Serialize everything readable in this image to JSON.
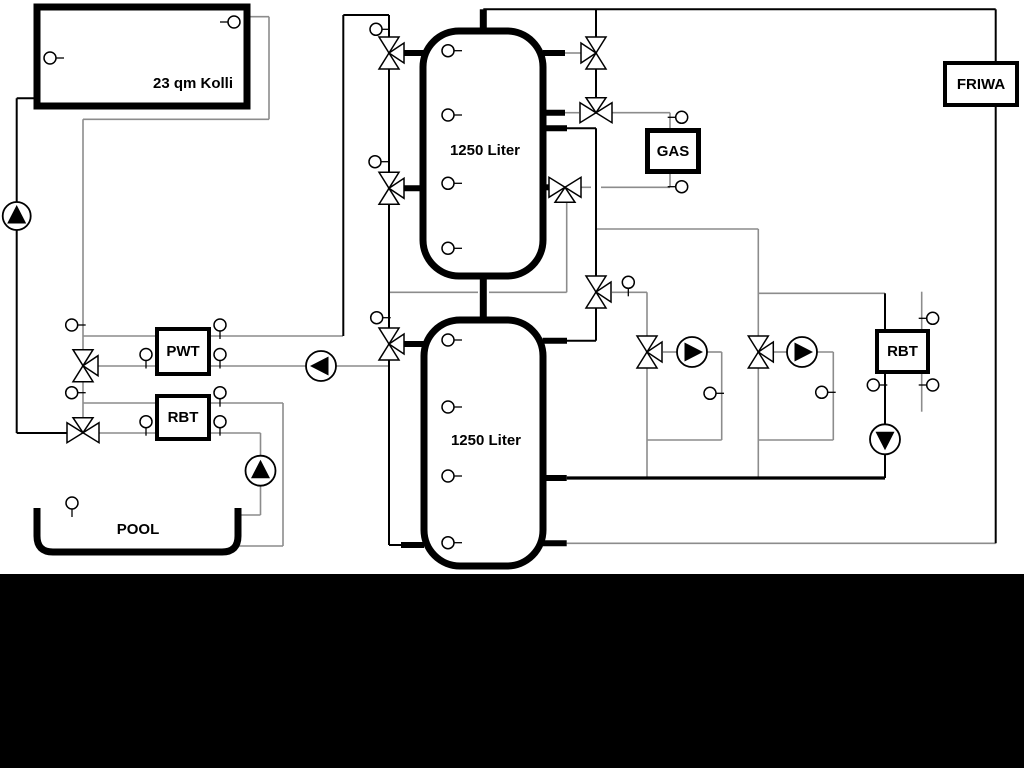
{
  "title": "Heating / solar / pool hydraulic schematic",
  "colors": {
    "background": "#ffffff",
    "pipe_gray": "#8c8c8c",
    "pipe_black": "#000000",
    "band": "#000000"
  },
  "labels": {
    "collector": "23 qm Kolli",
    "upper_tank": "1250 Liter",
    "lower_tank": "1250 Liter",
    "pwt": "PWT",
    "rbt_pool": "RBT",
    "rbt_right": "RBT",
    "gas": "GAS",
    "friwa": "FRIWA",
    "pool": "POOL"
  },
  "vessels": [
    {
      "name": "solar-collector",
      "kind": "rect",
      "x": 37,
      "y": 7,
      "w": 210,
      "h": 99,
      "rx": 0,
      "sw": 7
    },
    {
      "name": "upper-buffer-tank",
      "kind": "rect",
      "x": 423,
      "y": 31,
      "w": 120,
      "h": 245,
      "rx": 36,
      "sw": 7
    },
    {
      "name": "lower-buffer-tank",
      "kind": "rect",
      "x": 424,
      "y": 320,
      "w": 119,
      "h": 246,
      "rx": 36,
      "sw": 7
    },
    {
      "name": "pool-basin",
      "kind": "path",
      "d": "M 37 508 L 37 536 Q 37 552 53 552 L 222 552 Q 238 552 238 536 L 238 508",
      "sw": 7
    }
  ],
  "pipes": {
    "gray": [
      [
        245,
        16.7,
        269,
        16.7
      ],
      [
        269,
        16.7,
        269,
        119.3
      ],
      [
        83,
        119.3,
        269,
        119.3
      ],
      [
        83,
        119.3,
        83,
        350
      ],
      [
        83,
        381,
        83,
        417
      ],
      [
        83,
        336,
        156,
        336
      ],
      [
        210,
        336,
        343,
        336
      ],
      [
        97,
        366,
        156,
        366
      ],
      [
        210,
        366,
        306,
        366
      ],
      [
        336,
        366,
        389,
        366
      ],
      [
        83,
        403,
        156,
        403
      ],
      [
        210,
        403,
        283,
        403
      ],
      [
        283,
        403,
        283,
        546
      ],
      [
        238,
        546,
        283,
        546
      ],
      [
        97,
        433,
        156,
        433
      ],
      [
        210,
        433,
        260.5,
        433
      ],
      [
        260.5,
        433,
        260.5,
        456
      ],
      [
        260.5,
        486,
        260.5,
        515
      ],
      [
        238,
        515,
        260.5,
        515
      ],
      [
        389,
        292.3,
        478,
        292.3
      ],
      [
        489,
        292.3,
        566.7,
        292.3
      ],
      [
        566.7,
        203,
        566.7,
        292.3
      ],
      [
        596,
        229,
        758.3,
        229
      ],
      [
        758.3,
        229,
        758.3,
        336
      ],
      [
        758.3,
        368,
        758.3,
        478
      ],
      [
        758.3,
        293.3,
        885,
        293.3
      ],
      [
        612,
        292.3,
        647,
        292.3
      ],
      [
        647,
        292.3,
        647,
        336
      ],
      [
        647,
        368,
        647,
        478
      ],
      [
        663,
        352,
        677,
        352
      ],
      [
        707,
        352,
        721.7,
        352
      ],
      [
        721.7,
        352,
        721.7,
        440
      ],
      [
        647,
        440,
        721.7,
        440
      ],
      [
        774,
        352,
        787,
        352
      ],
      [
        817,
        352,
        833.3,
        352
      ],
      [
        833.3,
        352,
        833.3,
        440
      ],
      [
        758.3,
        440,
        833.3,
        440
      ],
      [
        921.7,
        291.7,
        921.7,
        411.7
      ],
      [
        566.7,
        543.3,
        995.7,
        543.3
      ],
      [
        580,
        187.3,
        591,
        187.3
      ],
      [
        601,
        187.3,
        670,
        187.3
      ],
      [
        670,
        173.3,
        670,
        187.3
      ],
      [
        612,
        112.7,
        670,
        112.7
      ],
      [
        670,
        112.7,
        670,
        128
      ],
      [
        565,
        53,
        581,
        53
      ],
      [
        565,
        112.7,
        579,
        112.7
      ]
    ],
    "black": [
      [
        16.7,
        98.3,
        37.3,
        98.3
      ],
      [
        16.7,
        98.3,
        16.7,
        202
      ],
      [
        16.7,
        230,
        16.7,
        433
      ],
      [
        16.7,
        433,
        67,
        433
      ],
      [
        343.3,
        15,
        389,
        15
      ],
      [
        343.3,
        15,
        343.3,
        336
      ],
      [
        389,
        15,
        389,
        37
      ],
      [
        389,
        69,
        389,
        172
      ],
      [
        389,
        204,
        389,
        328
      ],
      [
        389,
        360,
        389,
        545
      ],
      [
        389,
        545,
        403,
        545
      ],
      [
        483.3,
        9.3,
        995.7,
        9.3
      ],
      [
        596,
        9.3,
        596,
        37
      ],
      [
        596,
        69,
        596,
        97
      ],
      [
        566.7,
        128.3,
        596,
        128.3
      ],
      [
        596,
        128.3,
        596,
        276
      ],
      [
        596,
        308,
        596,
        340.7
      ],
      [
        567,
        340.7,
        596,
        340.7
      ],
      [
        995.7,
        9.3,
        995.7,
        61
      ],
      [
        995.7,
        107,
        995.7,
        543.3
      ],
      [
        885,
        293.3,
        885,
        329
      ],
      [
        885,
        373.3,
        885,
        424
      ],
      [
        885,
        455,
        885,
        478
      ]
    ],
    "heavy": [
      [
        566.7,
        478,
        885,
        478
      ]
    ],
    "stub": [
      [
        400,
        53,
        424,
        53
      ],
      [
        542.7,
        53,
        565,
        53
      ],
      [
        542.7,
        112.7,
        565,
        112.7
      ],
      [
        542.7,
        128.3,
        567,
        128.3
      ],
      [
        542.7,
        187.3,
        553,
        187.3
      ],
      [
        400,
        188.3,
        424,
        188.3
      ],
      [
        401,
        344,
        424,
        344
      ],
      [
        542.7,
        340.7,
        567,
        340.7
      ],
      [
        401,
        545,
        424,
        545
      ],
      [
        542.7,
        478,
        566.7,
        478
      ],
      [
        542.7,
        543.3,
        566.7,
        543.3
      ]
    ],
    "thick": [
      [
        483.3,
        9.3,
        483.3,
        31
      ],
      [
        483.3,
        275.7,
        483.3,
        320
      ]
    ]
  },
  "valves": [
    {
      "name": "tank-top-left-valve",
      "x": 389,
      "y": 53,
      "axis": "v",
      "branch": "right"
    },
    {
      "name": "tank-top-right-valve",
      "x": 596,
      "y": 53,
      "axis": "v",
      "branch": "left"
    },
    {
      "name": "gas-supply-valve",
      "x": 596,
      "y": 112.7,
      "axis": "h",
      "branch": "top"
    },
    {
      "name": "tank-mid-left-valve",
      "x": 389,
      "y": 188.3,
      "axis": "v",
      "branch": "right"
    },
    {
      "name": "gas-return-valve",
      "x": 565,
      "y": 187.3,
      "axis": "h",
      "branch": "bottom"
    },
    {
      "name": "heating-supply-valve",
      "x": 596,
      "y": 292,
      "axis": "v",
      "branch": "right"
    },
    {
      "name": "pwt-supply-valve",
      "x": 83,
      "y": 365.7,
      "axis": "v",
      "branch": "right"
    },
    {
      "name": "lower-tank-left-valve",
      "x": 389,
      "y": 344,
      "axis": "v",
      "branch": "right"
    },
    {
      "name": "solar-return-valve",
      "x": 83,
      "y": 432.7,
      "axis": "h",
      "branch": "top"
    },
    {
      "name": "circuit1-mixing-valve",
      "x": 647,
      "y": 352,
      "axis": "v",
      "branch": "right"
    },
    {
      "name": "circuit2-mixing-valve",
      "x": 758.3,
      "y": 352,
      "axis": "v",
      "branch": "right"
    }
  ],
  "pumps": [
    {
      "name": "solar-pump",
      "x": 16.7,
      "y": 216,
      "dir": "up",
      "r": 14
    },
    {
      "name": "pwt-pump",
      "x": 321,
      "y": 366,
      "dir": "left",
      "r": 15
    },
    {
      "name": "pool-pump",
      "x": 260.5,
      "y": 470.7,
      "dir": "up",
      "r": 15
    },
    {
      "name": "heating-pump-1",
      "x": 692,
      "y": 352,
      "dir": "right",
      "r": 15
    },
    {
      "name": "heating-pump-2",
      "x": 802,
      "y": 352,
      "dir": "right",
      "r": 15
    },
    {
      "name": "rbt-right-pump",
      "x": 885,
      "y": 439.3,
      "dir": "down",
      "r": 15
    }
  ],
  "sensors": [
    {
      "name": "collector-sensor-top",
      "x": 234,
      "y": 22,
      "stem": "left"
    },
    {
      "name": "collector-sensor-bottom",
      "x": 50,
      "y": 58,
      "stem": "right"
    },
    {
      "name": "upper-tank-sensor-1",
      "x": 448,
      "y": 50.7,
      "stem": "right"
    },
    {
      "name": "upper-tank-sensor-2",
      "x": 448,
      "y": 115,
      "stem": "right"
    },
    {
      "name": "upper-tank-sensor-3",
      "x": 448,
      "y": 183.3,
      "stem": "right"
    },
    {
      "name": "upper-tank-sensor-4",
      "x": 448,
      "y": 248.3,
      "stem": "right"
    },
    {
      "name": "lower-tank-sensor-1",
      "x": 448,
      "y": 340,
      "stem": "right"
    },
    {
      "name": "lower-tank-sensor-2",
      "x": 448,
      "y": 407,
      "stem": "right"
    },
    {
      "name": "lower-tank-sensor-3",
      "x": 448,
      "y": 476,
      "stem": "right"
    },
    {
      "name": "lower-tank-sensor-4",
      "x": 448,
      "y": 542.7,
      "stem": "right"
    },
    {
      "name": "line-sensor",
      "x": 376,
      "y": 29.3,
      "stem": "right"
    },
    {
      "name": "line-sensor",
      "x": 375,
      "y": 161.7,
      "stem": "right"
    },
    {
      "name": "line-sensor",
      "x": 376.7,
      "y": 317.7,
      "stem": "right"
    },
    {
      "name": "line-sensor",
      "x": 71.7,
      "y": 325,
      "stem": "right"
    },
    {
      "name": "line-sensor",
      "x": 71.7,
      "y": 392.7,
      "stem": "right"
    },
    {
      "name": "line-sensor",
      "x": 146,
      "y": 354.5,
      "stem": "down"
    },
    {
      "name": "line-sensor",
      "x": 220,
      "y": 325,
      "stem": "down"
    },
    {
      "name": "line-sensor",
      "x": 220,
      "y": 354.5,
      "stem": "down"
    },
    {
      "name": "line-sensor",
      "x": 146,
      "y": 421.7,
      "stem": "down"
    },
    {
      "name": "line-sensor",
      "x": 220,
      "y": 392.7,
      "stem": "down"
    },
    {
      "name": "line-sensor",
      "x": 220,
      "y": 421.7,
      "stem": "down"
    },
    {
      "name": "pool-sensor",
      "x": 72,
      "y": 503,
      "stem": "down"
    },
    {
      "name": "line-sensor",
      "x": 628.3,
      "y": 282.3,
      "stem": "down"
    },
    {
      "name": "gas-supply-sensor",
      "x": 681.7,
      "y": 117.3,
      "stem": "left"
    },
    {
      "name": "gas-return-sensor",
      "x": 681.7,
      "y": 186.7,
      "stem": "left"
    },
    {
      "name": "line-sensor",
      "x": 710,
      "y": 393.3,
      "stem": "right"
    },
    {
      "name": "line-sensor",
      "x": 821.7,
      "y": 392.3,
      "stem": "right"
    },
    {
      "name": "line-sensor",
      "x": 873.3,
      "y": 385,
      "stem": "right"
    },
    {
      "name": "line-sensor",
      "x": 932.7,
      "y": 318.3,
      "stem": "left"
    },
    {
      "name": "line-sensor",
      "x": 932.7,
      "y": 385,
      "stem": "left"
    }
  ]
}
